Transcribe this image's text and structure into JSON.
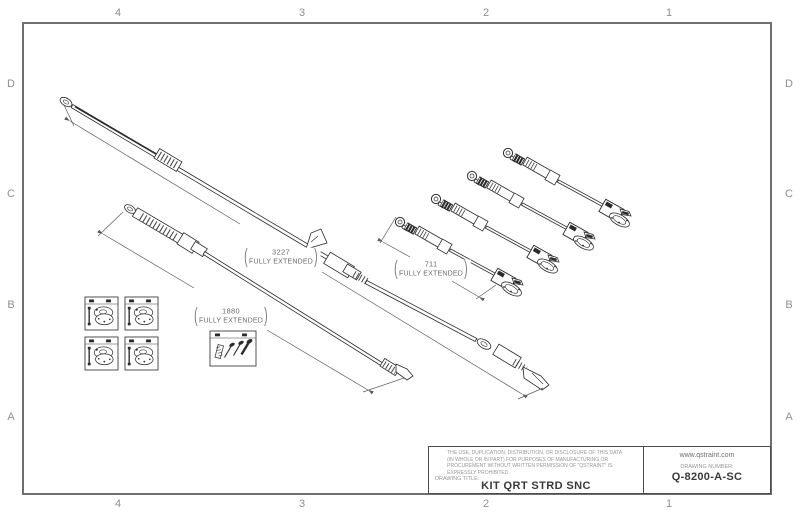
{
  "sheet": {
    "zones": {
      "columns": [
        "4",
        "3",
        "2",
        "1"
      ],
      "rows": [
        "D",
        "C",
        "B",
        "A"
      ]
    }
  },
  "dimensions": {
    "long_strap": {
      "value": "3227",
      "note": "FULLY EXTENDED"
    },
    "medium_strap": {
      "value": "1880",
      "note": "FULLY EXTENDED"
    },
    "short_strap": {
      "value": "711",
      "note": "FULLY EXTENDED"
    }
  },
  "title_block": {
    "legal_notice": "THE USE, DUPLICATION, DISTRIBUTION, OR DISCLOSURE OF THIS DATA (IN WHOLE OR IN PART) FOR PURPOSES OF MANUFACTURING OR PROCUREMENT WITHOUT WRITTEN PERMISSION OF \"QSTRAINT\" IS EXPRESSLY PROHIBITED.",
    "drawing_title_label": "DRAWING TITLE:",
    "drawing_title": "KIT QRT STRD SNC",
    "website": "www.qstraint.com",
    "drawing_number_label": "DRAWING NUMBER:",
    "drawing_number": "Q-8200-A-SC"
  },
  "colors": {
    "line": "#2b2b2b",
    "dim_line": "#5a5a5a",
    "grid_label": "#8f8f8f",
    "border": "#6f6f6f"
  }
}
